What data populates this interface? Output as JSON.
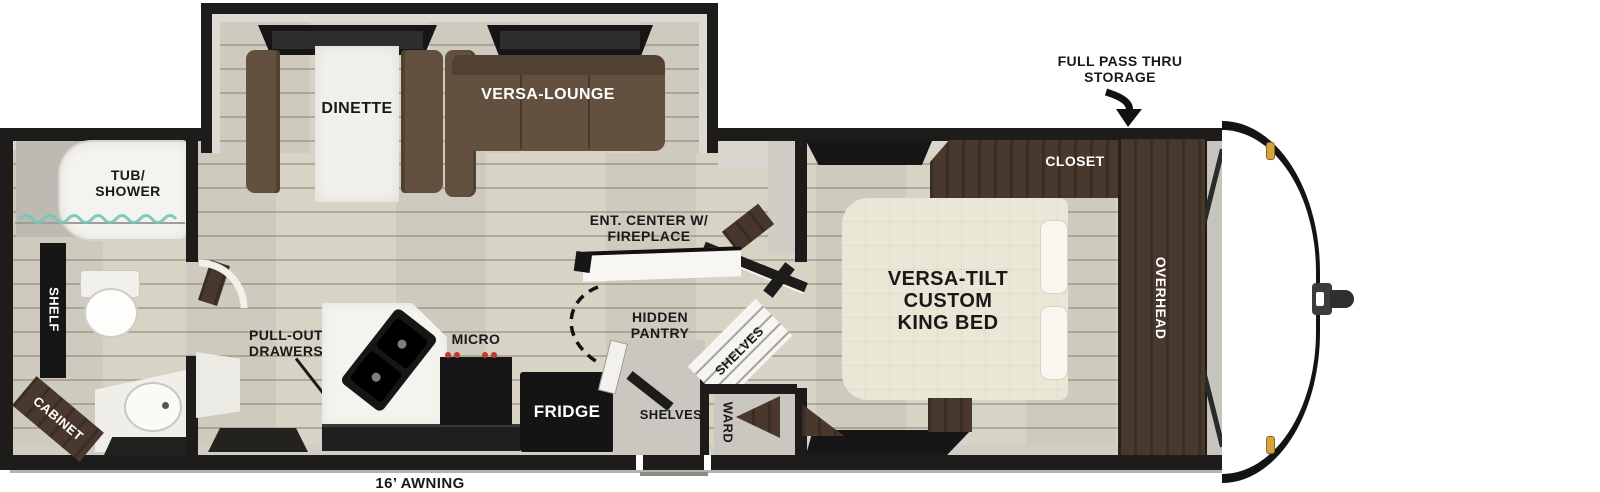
{
  "floorplan": {
    "callouts": {
      "full_pass_thru_storage": "FULL PASS THRU\nSTORAGE",
      "awning": "16’ AWNING"
    },
    "living": {
      "dinette": "DINETTE",
      "versa_lounge": "VERSA-LOUNGE",
      "ent_center": "ENT. CENTER W/\nFIREPLACE"
    },
    "galley": {
      "pull_out_drawers": "PULL-OUT\nDRAWERS",
      "micro": "MICRO",
      "fridge": "FRIDGE",
      "hidden_pantry": "HIDDEN\nPANTRY",
      "shelves_upper": "SHELVES",
      "shelves_lower": "SHELVES",
      "ward": "WARD"
    },
    "bedroom": {
      "bed": "VERSA-TILT\nCUSTOM\nKING BED",
      "closet": "CLOSET",
      "overhead": "OVERHEAD"
    },
    "bath": {
      "tub_shower": "TUB/\nSHOWER",
      "shelf": "SHELF",
      "cabinet": "CABINET"
    },
    "colors": {
      "wall": "#1d1c1a",
      "dark_wood": "#49382d",
      "sofa_brown": "#63503f",
      "floor_beige": "#d7d3c5",
      "bed_cream": "#ebe7d6",
      "marker_amber": "#d9a33c",
      "burner_red": "#c0392b",
      "curtain_teal": "#74c6b8"
    }
  }
}
